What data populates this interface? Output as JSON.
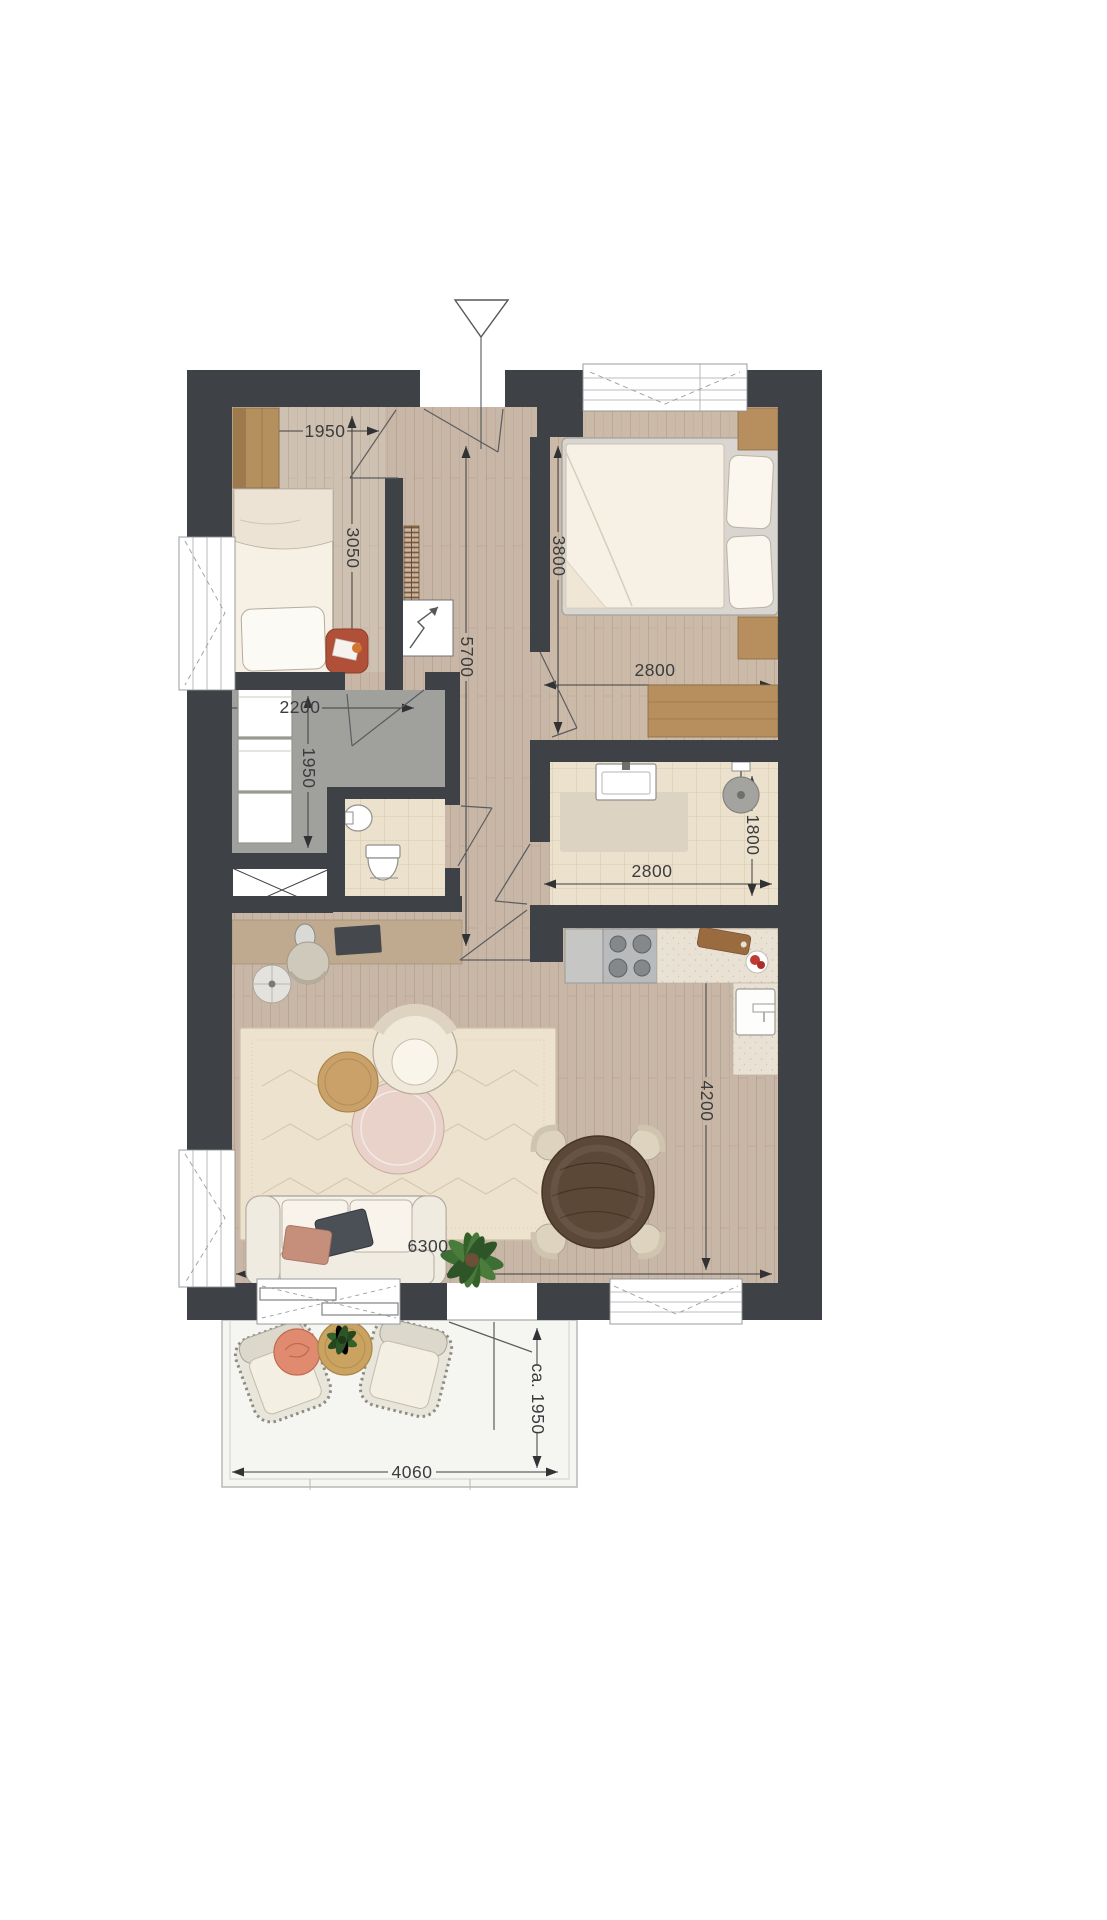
{
  "document": {
    "type": "architectural floor plan",
    "description": "Top-down furnished apartment floor plan with dimensions in millimetres and a terrace"
  },
  "colors": {
    "wall": "#3e4145",
    "wood_floor": "#c8b6a6",
    "wood_floor_light": "#cfc1b1",
    "storage_floor_gray": "#a0a09d",
    "tile_floor": "#ebe1cc",
    "kitchen_counter": "#e9e2d4",
    "terrace_floor": "#f5f5f2",
    "furniture_wood": "#b78f5e",
    "dining_table_wood": "#5c4837",
    "sofa_cream": "#f5f1e9",
    "plant_green": "#3d6e33",
    "coral_cushion": "#e08a6f",
    "red_side_table": "#b05038",
    "dimension_text": "#3a3c3e"
  },
  "entrance": {
    "marker": "triangle"
  },
  "dimensions": {
    "bedroom_small": {
      "width": "1950",
      "depth": "3050"
    },
    "bedroom_main": {
      "width": "2800",
      "depth": "3800"
    },
    "hall": {
      "length": "5700"
    },
    "storage": {
      "width": "2200",
      "depth": "1950"
    },
    "bathroom": {
      "width": "2800",
      "depth": "1800"
    },
    "living_room": {
      "width": "6300",
      "depth": "4200"
    },
    "terrace": {
      "width": "4060",
      "depth": "ca. 1950"
    }
  }
}
